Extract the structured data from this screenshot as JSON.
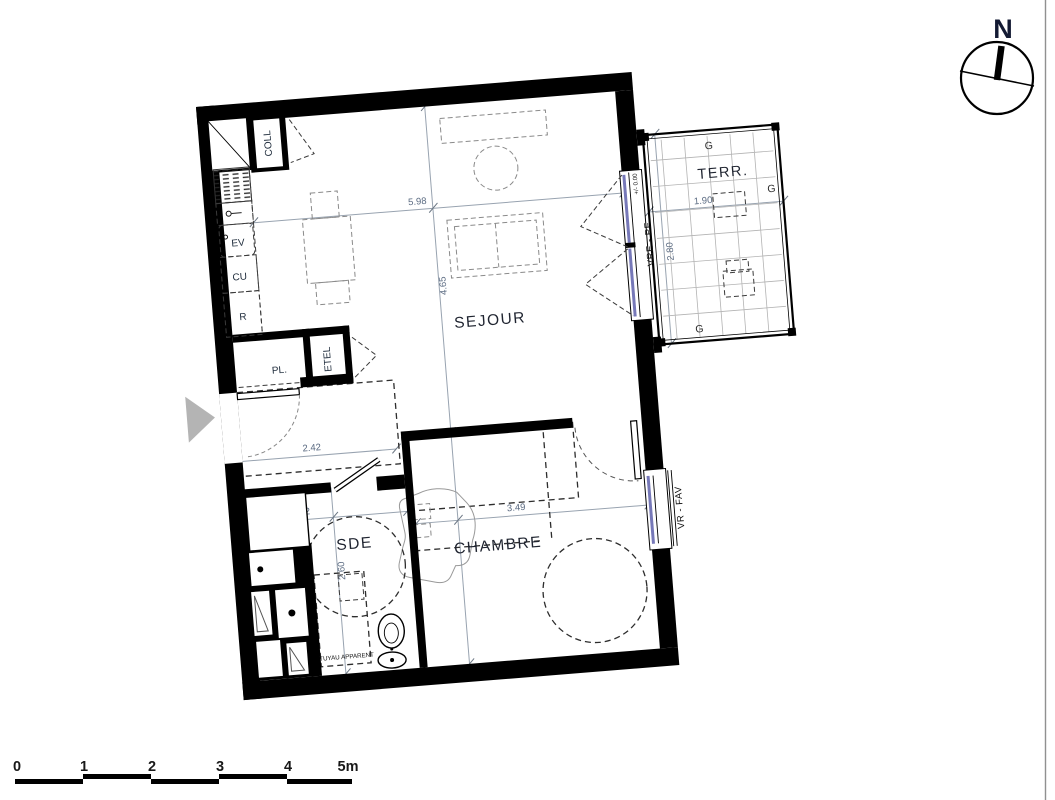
{
  "colors": {
    "wall": "#000000",
    "glazing": "#7678b8",
    "dimension_text": "#5b6b82",
    "furniture": "#8a8a8a",
    "room_label": "#1f2430",
    "tile_grid": "#b3b3b3",
    "entry_arrow": "#b4b4b4",
    "page_border": "#909090"
  },
  "compass": {
    "label": "N"
  },
  "rooms": {
    "sejour": "SEJOUR",
    "chambre": "CHAMBRE",
    "sde": "SDE",
    "terrace": "TERR."
  },
  "labels": {
    "coll": "COLL",
    "pl": "PL.",
    "etel": "ETEL",
    "ev": "EV",
    "cu": "CU",
    "r": "R",
    "tuyau": "TUYAU APPARENT"
  },
  "windows": {
    "sejour": "VRE - PF",
    "chambre": "VR - FAV",
    "level": "+/- 0.00"
  },
  "dimensions": {
    "sejour_width": "5.98",
    "sejour_height": "4.65",
    "hall_width": "2.42",
    "sde_width": "2.42",
    "sde_height": "2.60",
    "chambre_width": "3.49",
    "terrace_width": "1.90",
    "terrace_height": "2.80"
  },
  "terrace": {
    "g_labels": [
      "G",
      "G",
      "G"
    ]
  },
  "scale_bar": {
    "labels": [
      "0",
      "1",
      "2",
      "3",
      "4",
      "5m"
    ]
  }
}
